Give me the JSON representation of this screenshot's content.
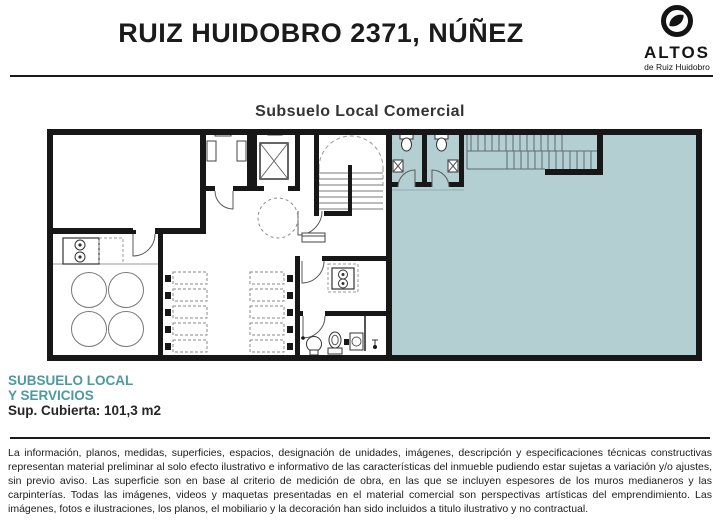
{
  "header": {
    "title": "RUIZ HUIDOBRO 2371, NÚÑEZ"
  },
  "logo": {
    "brand": "ALTOS",
    "subtitle": "de Ruiz Huidobro"
  },
  "plan": {
    "title": "Subsuelo Local Comercial",
    "highlight_color": "#b3cfd2",
    "wall_color": "#171717"
  },
  "footer": {
    "unit_name_line1": "SUBSUELO LOCAL",
    "unit_name_line2": "Y SERVICIOS",
    "area_label": "Sup. Cubierta: 101,3 m2",
    "accent_color": "#4b9aa2"
  },
  "disclaimer": "La información, planos, medidas, superficies, espacios, designación de unidades, imágenes, descripción y especificaciones técnicas constructivas representan material preliminar al solo efecto ilustrativo e informativo de las características del inmueble pudiendo estar sujetas a variación y/o ajustes, sin previo aviso. Las superficie son en base al criterio de medición de obra, en las que se incluyen espesores de los muros medianeros y las carpinterías. Todas las imágenes, videos y maquetas presentadas en el material comercial son perspectivas artísticas del emprendimiento. Las imágenes, fotos e ilustraciones, los planos, el mobiliario y la decoración han sido incluidos a titulo ilustrativo y no contractual."
}
